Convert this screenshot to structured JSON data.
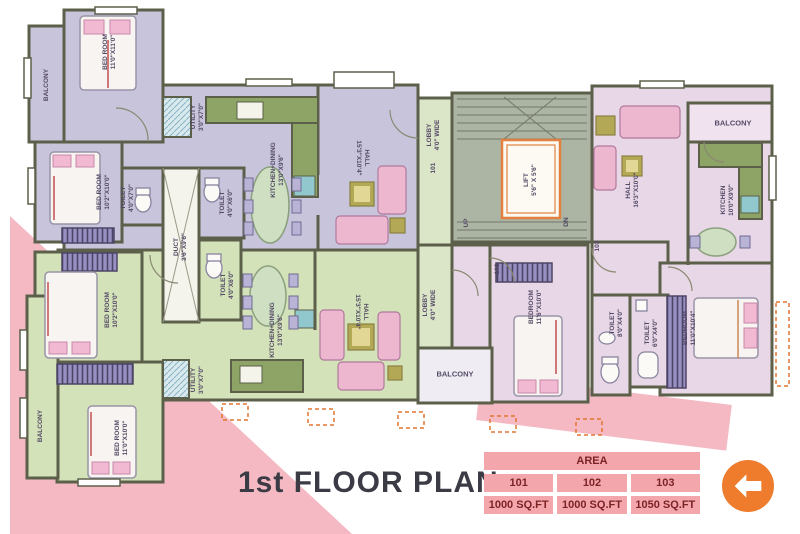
{
  "title": "1st FLOOR PLAN",
  "area_table": {
    "header": "AREA",
    "columns": [
      "101",
      "102",
      "103"
    ],
    "areas": [
      "1000 SQ.FT",
      "1000 SQ.FT",
      "1050 SQ.FT"
    ]
  },
  "plan": {
    "stairs": {
      "lift": "LIFT\n5'6\" X 5'6\"",
      "up": "UP",
      "dn": "DN"
    },
    "shared": {
      "duct": "DUCT\n3'6\"X9'6\""
    },
    "u101": {
      "balcony": "BALCONY",
      "bedroom1": "BED ROOM\n11'0\"X11'0\"",
      "bedroom2": "BED ROOM\n10'2\"X10'0\"",
      "toilet1": "TOILET\n4'0\"X7'0\"",
      "toilet2": "TOILET\n4'0\"X6'0\"",
      "utility": "UTILITY\n3'0\"X7'0\"",
      "kitchen": "KITCHEN+DINING\n13'0\"X9'6\"",
      "hall": "HALL\n15'3\"X10'4\"",
      "lobby": "LOBBY\n4'0\" WIDE",
      "door": "101"
    },
    "u102": {
      "balcony1": "BALCONY",
      "balcony2": "BALCONY",
      "bedroom1": "BED ROOM\n10'2\"X10'0\"",
      "bedroom2": "BED ROOM\n11'0\"X10'0\"",
      "bedroom3": "BEDROOM\n11'6\"X10'0\"",
      "toilet": "TOILET\n4'0\"X6'0\"",
      "utility": "UTILITY\n3'0\"X7'0\"",
      "kitchen": "KITCHEN+DINING\n13'0\"X9'6\"",
      "hall": "HALL\n15'3\"X10'4\"",
      "lobby": "LOBBY\n4'0\" WIDE",
      "door": "102"
    },
    "u103": {
      "balcony": "BALCONY",
      "hall": "HALL\n16'3\"X10'0\"",
      "kitchen": "KITCHEN\n10'0\"X9'0\"",
      "bedroom": "BEDROOM\n11'0\"X10'4\"",
      "toilet1": "TOILET\n8'0\"X4'0\"",
      "toilet2": "TOILET\n6'0\"X4'0\"",
      "door": "103"
    }
  },
  "back_button": {
    "icon": "left-arrow"
  },
  "colors": {
    "accent_orange": "#ee7c2c",
    "pink_banner": "#f4b9c3",
    "table_cell": "#f3a6ab",
    "wall": "#5c604a"
  }
}
